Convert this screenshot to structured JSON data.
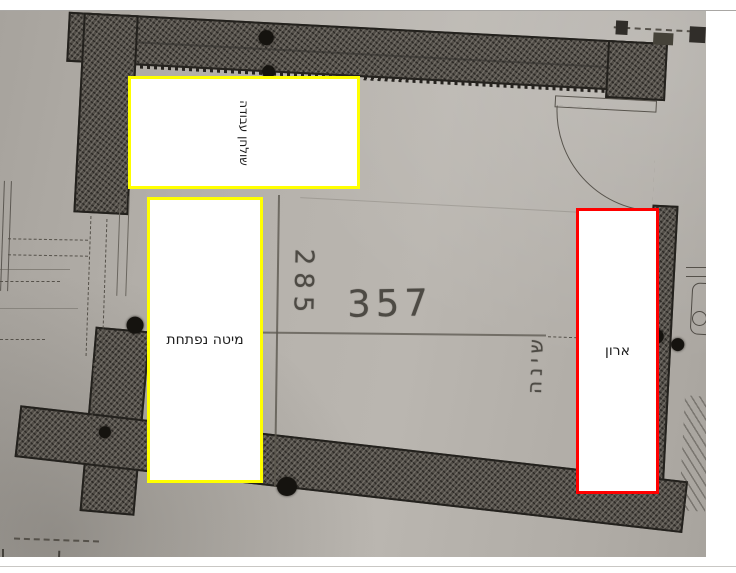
{
  "plan": {
    "dim_vertical": "285",
    "dim_horizontal": "357",
    "room_label": "שינה",
    "paper_hex": "#b4b0aa",
    "wall_hex": "#514d47",
    "line_hex": "#57534d"
  },
  "annotations": {
    "yellow_hex": "#ffff00",
    "red_hex": "#ff0000",
    "boxes": [
      {
        "id": "desk",
        "label": "שולחן עבודה",
        "border": "#ffff00",
        "orientation": "vertical"
      },
      {
        "id": "bed",
        "label": "מיטה נפתחת",
        "border": "#ffff00",
        "orientation": "horizontal"
      },
      {
        "id": "closet",
        "label": "ארון",
        "border": "#ff0000",
        "orientation": "horizontal"
      }
    ]
  }
}
